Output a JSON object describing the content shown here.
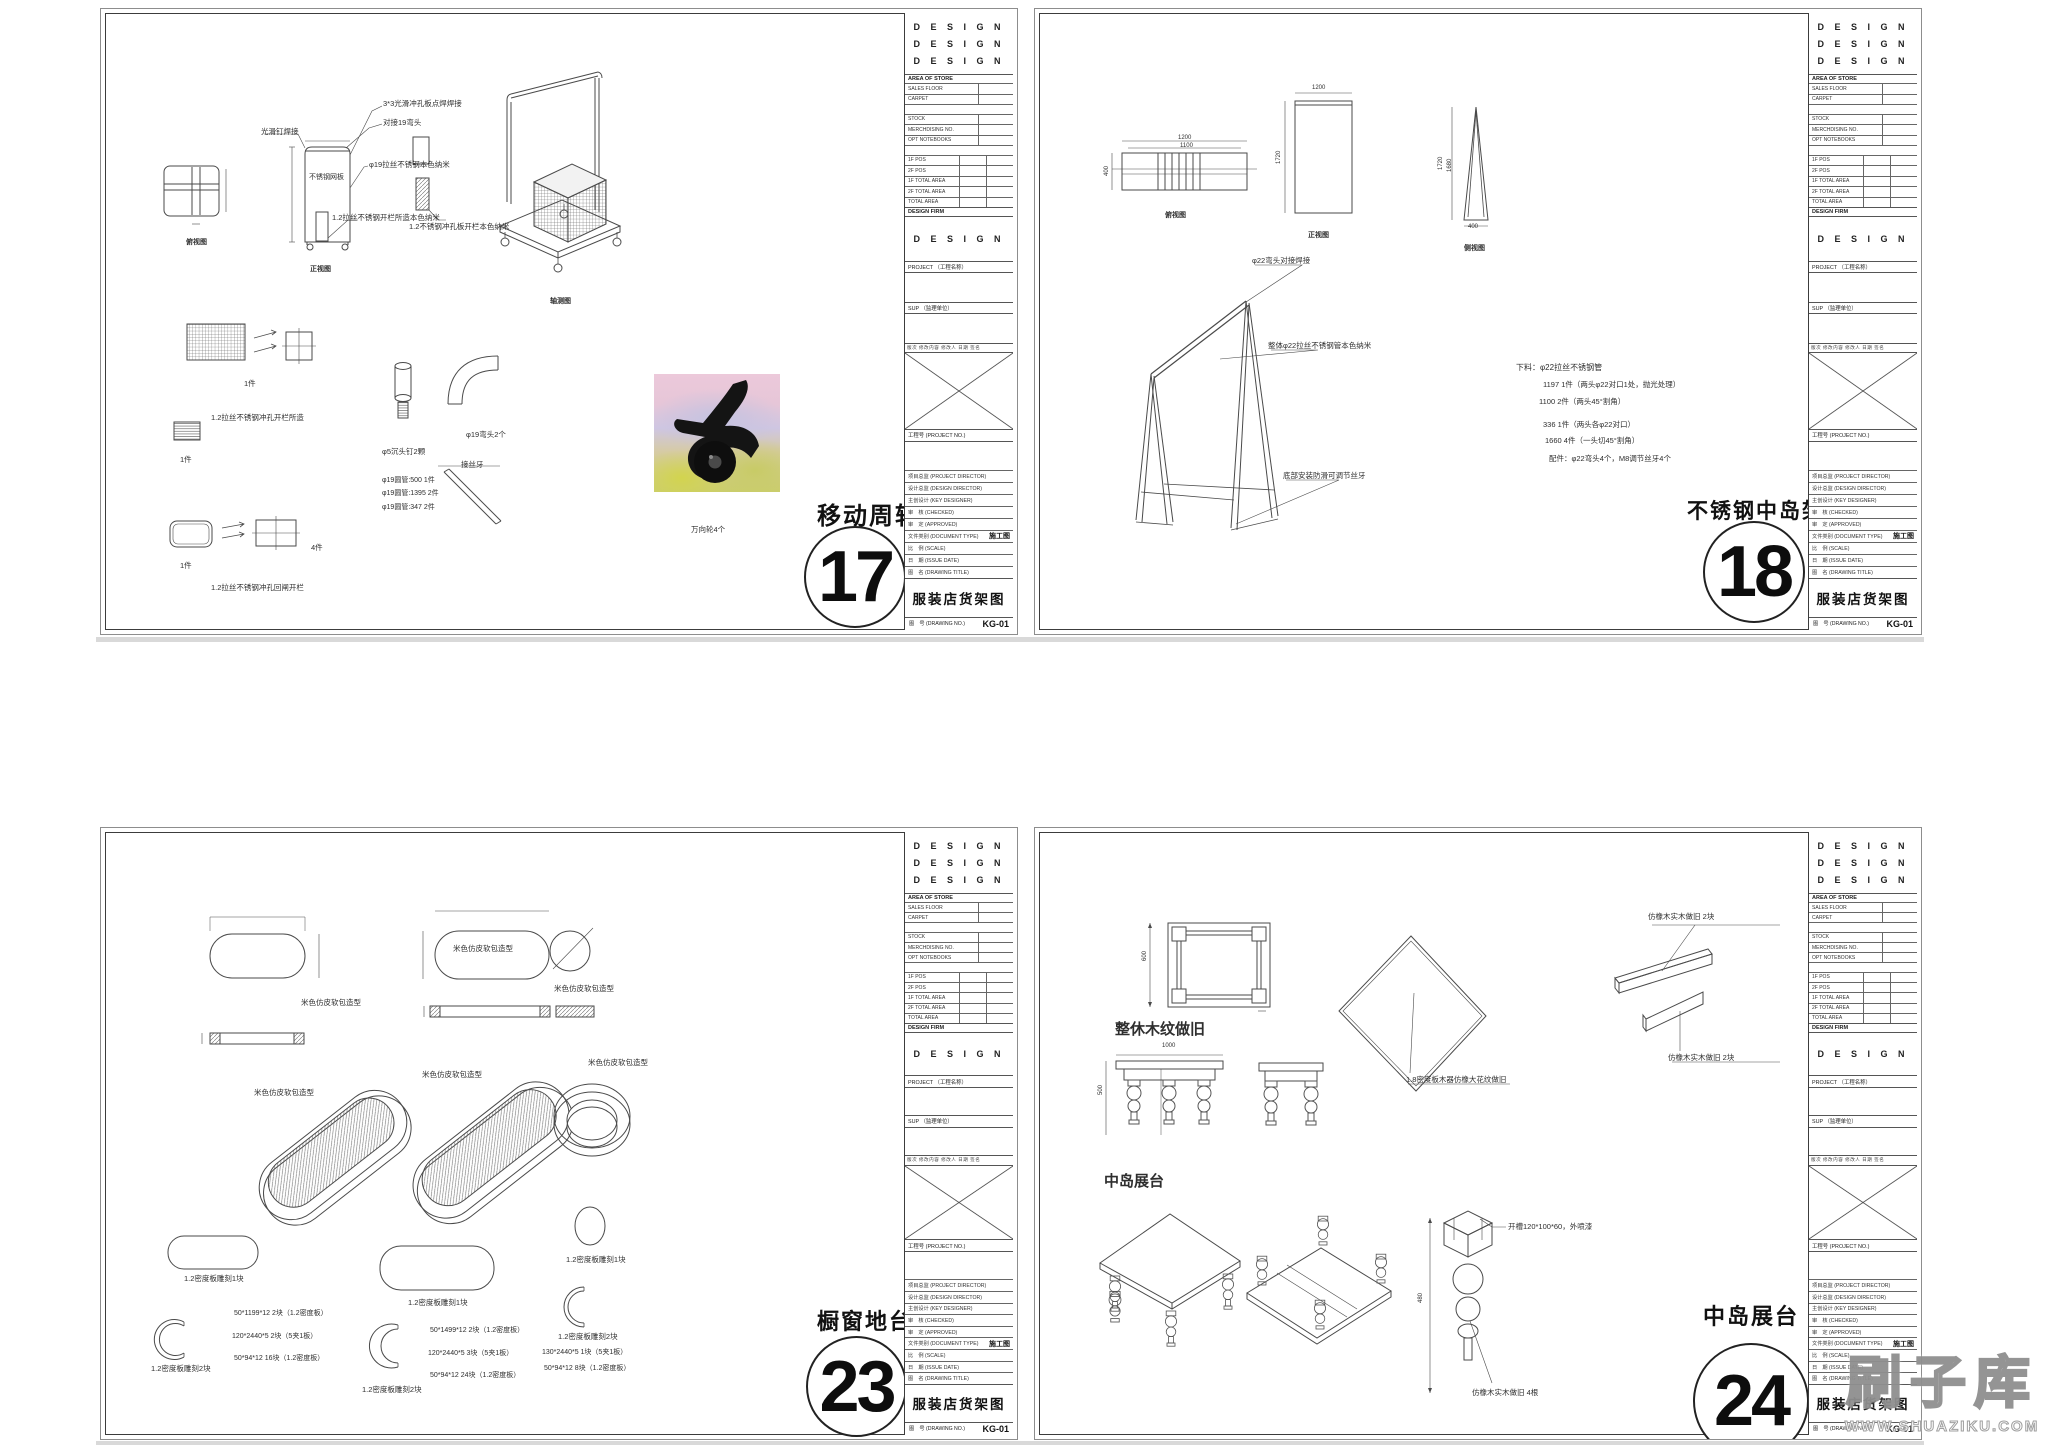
{
  "watermark": {
    "brand": "刷子库",
    "url": "WWW.SHUAZIKU.COM"
  },
  "titleblock": {
    "design_rows": [
      "D E S I G N",
      "D E S I G N",
      "D E S I G N"
    ],
    "area_header": "AREA OF STORE",
    "rows1": [
      "SALES FLOOR",
      "CARPET"
    ],
    "rows2": [
      "STOCK",
      "MERCHDISING NO.",
      "OPT NOTEBOOKS"
    ],
    "rows3": [
      "1F  POS",
      "2F  POS",
      "1F TOTAL AREA",
      "2F TOTAL AREA",
      "TOTAL AREA"
    ],
    "firm_header": "DESIGN FIRM",
    "firm_name": "D E S I G N",
    "project_label": "PROJECT （工程名称）",
    "sup_label": "SUP （监理单位）",
    "rev_header": "版次  修改内容  修改人  日期  签名",
    "project_no_label": "工程号 (PROJECT NO.)",
    "person_rows": [
      {
        "l": "项目总监 (PROJECT DIRECTOR)"
      },
      {
        "l": "设计总监 (DESIGN DIRECTOR)"
      },
      {
        "l": "主创设计 (KEY DESIGNER)"
      },
      {
        "l": "审　核 (CHECKED)"
      },
      {
        "l": "审　定 (APPROVED)"
      },
      {
        "l": "文件类别 (DOCUMENT TYPE)",
        "v": "施工图"
      },
      {
        "l": "比　例 (SCALE)"
      },
      {
        "l": "日　期 (ISSUE DATE)"
      },
      {
        "l": "图　名 (DRAWING TITLE)"
      }
    ],
    "drawing_title": "服装店货架图",
    "no_label": "图　号 (DRAWING NO.)",
    "no_value": "KG-01"
  },
  "sheets": [
    {
      "number": "17",
      "title": "移动周转架",
      "annotations": [
        {
          "t": "3*3光滑冲孔板点焊焊接",
          "x": 277,
          "y": 86
        },
        {
          "t": "对接19弯头",
          "x": 277,
          "y": 105
        },
        {
          "t": "光滑钉焊接",
          "x": 155,
          "y": 114
        },
        {
          "t": "φ19拉丝不锈钢本色纳米",
          "x": 263,
          "y": 147
        },
        {
          "t": "不锈钢网板",
          "x": 203,
          "y": 160,
          "s": 7
        },
        {
          "t": "1.2拉丝不锈钢开栏所造本色纳米",
          "x": 226,
          "y": 200
        },
        {
          "t": "1.2不锈钢冲孔板开栏本色纳米",
          "x": 303,
          "y": 209
        },
        {
          "t": "俯视图",
          "x": 80,
          "y": 225,
          "s": 7,
          "b": 1
        },
        {
          "t": "正视图",
          "x": 204,
          "y": 252,
          "s": 7,
          "b": 1
        },
        {
          "t": "轴测图",
          "x": 444,
          "y": 284,
          "s": 7,
          "b": 1
        },
        {
          "t": "1件",
          "x": 138,
          "y": 366
        },
        {
          "t": "1.2拉丝不锈钢冲孔开栏所造",
          "x": 105,
          "y": 400
        },
        {
          "t": "1件",
          "x": 74,
          "y": 442
        },
        {
          "t": "1件",
          "x": 74,
          "y": 548
        },
        {
          "t": "4件",
          "x": 205,
          "y": 530
        },
        {
          "t": "1.2拉丝不锈钢冲孔回闸开栏",
          "x": 105,
          "y": 570
        },
        {
          "t": "φ5沉头钉2颗",
          "x": 276,
          "y": 434
        },
        {
          "t": "φ19弯头2个",
          "x": 360,
          "y": 417
        },
        {
          "t": "接丝牙",
          "x": 355,
          "y": 447
        },
        {
          "t": "φ19圆管:500 1件",
          "x": 276,
          "y": 463,
          "s": 7
        },
        {
          "t": "φ19圆管:1395 2件",
          "x": 276,
          "y": 476,
          "s": 7
        },
        {
          "t": "φ19圆管:347 2件",
          "x": 276,
          "y": 490,
          "s": 7
        },
        {
          "t": "万向轮4个",
          "x": 585,
          "y": 512
        }
      ]
    },
    {
      "number": "18",
      "title": "不锈钢中岛架",
      "annotations": [
        {
          "t": "1200",
          "x": 138,
          "y": 121,
          "s": 6
        },
        {
          "t": "1100",
          "x": 140,
          "y": 129,
          "s": 6
        },
        {
          "t": "400",
          "x": 64,
          "y": 162,
          "s": 6,
          "r": -90
        },
        {
          "t": "俯视图",
          "x": 125,
          "y": 198,
          "s": 7,
          "b": 1
        },
        {
          "t": "1200",
          "x": 272,
          "y": 71,
          "s": 6
        },
        {
          "t": "1720",
          "x": 236,
          "y": 150,
          "s": 6,
          "r": -90
        },
        {
          "t": "正视图",
          "x": 268,
          "y": 218,
          "s": 7,
          "b": 1
        },
        {
          "t": "1720",
          "x": 398,
          "y": 156,
          "s": 6,
          "r": -90
        },
        {
          "t": "1680",
          "x": 407,
          "y": 158,
          "s": 6,
          "r": -90
        },
        {
          "t": "400",
          "x": 428,
          "y": 210,
          "s": 6
        },
        {
          "t": "侧视图",
          "x": 424,
          "y": 231,
          "s": 7,
          "b": 1
        },
        {
          "t": "φ22弯头对接焊接",
          "x": 212,
          "y": 243
        },
        {
          "t": "整体φ22拉丝不锈钢管本色纳米",
          "x": 228,
          "y": 328
        },
        {
          "t": "底部安装防滑可调节丝牙",
          "x": 243,
          "y": 458
        },
        {
          "t": "下料：φ22拉丝不锈钢管",
          "x": 476,
          "y": 349,
          "s": 8
        },
        {
          "t": "1197 1件（两头φ22对口1处，抛光处理）",
          "x": 503,
          "y": 367
        },
        {
          "t": "1100 2件（两头45°割角）",
          "x": 499,
          "y": 384
        },
        {
          "t": "336 1件（两头各φ22对口）",
          "x": 503,
          "y": 407
        },
        {
          "t": "1660 4件（一头切45°割角）",
          "x": 505,
          "y": 423
        },
        {
          "t": "配件：φ22弯头4个，M8调节丝牙4个",
          "x": 509,
          "y": 441
        }
      ]
    },
    {
      "number": "23",
      "title": "橱窗地台",
      "annotations": [
        {
          "t": "米色仿皮软包造型",
          "x": 195,
          "y": 166
        },
        {
          "t": "米色仿皮软包造型",
          "x": 347,
          "y": 112
        },
        {
          "t": "米色仿皮软包造型",
          "x": 448,
          "y": 152
        },
        {
          "t": "米色仿皮软包造型",
          "x": 148,
          "y": 256
        },
        {
          "t": "米色仿皮软包造型",
          "x": 316,
          "y": 238
        },
        {
          "t": "米色仿皮软包造型",
          "x": 482,
          "y": 226
        },
        {
          "t": "1.2密度板雕刻1块",
          "x": 78,
          "y": 442
        },
        {
          "t": "1.2密度板雕刻1块",
          "x": 302,
          "y": 466
        },
        {
          "t": "1.2密度板雕刻1块",
          "x": 460,
          "y": 423
        },
        {
          "t": "1.2密度板雕刻2块",
          "x": 45,
          "y": 532
        },
        {
          "t": "1.2密度板雕刻2块",
          "x": 256,
          "y": 553
        },
        {
          "t": "1.2密度板雕刻2块",
          "x": 452,
          "y": 500
        },
        {
          "t": "50*1199*12 2块（1.2密度板）",
          "x": 128,
          "y": 477,
          "s": 7
        },
        {
          "t": "120*2440*5 2块（5夹1板）",
          "x": 126,
          "y": 500,
          "s": 7
        },
        {
          "t": "50*94*12 16块（1.2密度板）",
          "x": 128,
          "y": 522,
          "s": 7
        },
        {
          "t": "50*1499*12 2块（1.2密度板）",
          "x": 324,
          "y": 494,
          "s": 7
        },
        {
          "t": "120*2440*5 3块（5夹1板）",
          "x": 322,
          "y": 517,
          "s": 7
        },
        {
          "t": "50*94*12 24块（1.2密度板）",
          "x": 324,
          "y": 539,
          "s": 7
        },
        {
          "t": "130*2440*5 1块（5夹1板）",
          "x": 436,
          "y": 516,
          "s": 7
        },
        {
          "t": "50*94*12 8块（1.2密度板）",
          "x": 438,
          "y": 532,
          "s": 7
        }
      ]
    },
    {
      "number": "24",
      "title": "中岛展台",
      "annotations": [
        {
          "t": "600",
          "x": 102,
          "y": 128,
          "s": 6,
          "r": -90
        },
        {
          "t": "整休木纹做旧",
          "x": 75,
          "y": 188,
          "s": 15,
          "b": 1
        },
        {
          "t": "1000",
          "x": 122,
          "y": 210,
          "s": 6
        },
        {
          "t": "500",
          "x": 58,
          "y": 262,
          "s": 6,
          "r": -90
        },
        {
          "t": "仿橡木实木做旧 2块",
          "x": 608,
          "y": 80
        },
        {
          "t": "仿橡木实木做旧 2块",
          "x": 628,
          "y": 221
        },
        {
          "t": "1.8密度板木器仿橡大花纹做旧",
          "x": 366,
          "y": 243
        },
        {
          "t": "中岛展台",
          "x": 64,
          "y": 340,
          "s": 15,
          "b": 1
        },
        {
          "t": "开槽120*100*60，外喷漆",
          "x": 468,
          "y": 390
        },
        {
          "t": "480",
          "x": 378,
          "y": 470,
          "s": 6,
          "r": -90
        },
        {
          "t": "仿橡木实木做旧 4根",
          "x": 432,
          "y": 556
        }
      ]
    }
  ]
}
